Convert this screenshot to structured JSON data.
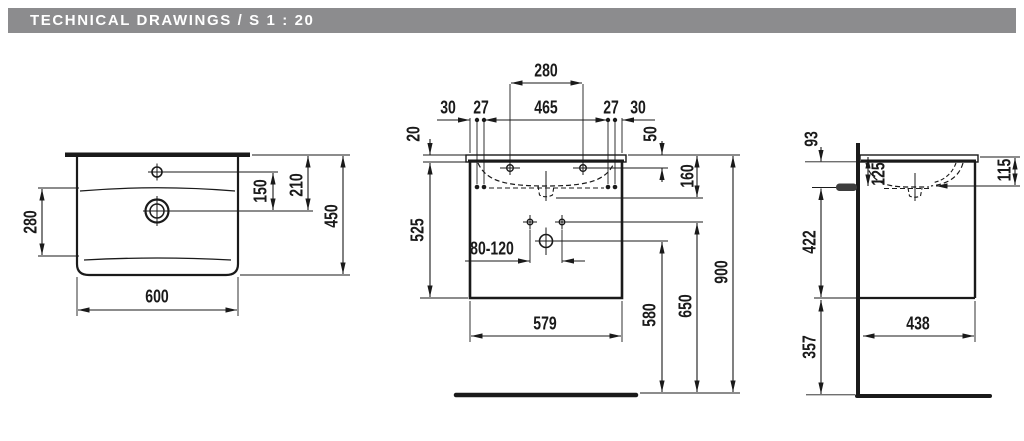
{
  "header": {
    "title": "TECHNICAL DRAWINGS / S 1 : 20"
  },
  "colors": {
    "header_bg": "#8c8c8e",
    "header_text": "#ffffff",
    "line": "#1a1a1a",
    "background": "#ffffff"
  },
  "dims": {
    "basin_width": "600",
    "basin_height": "450",
    "basin_inner_depth": "280",
    "faucet_to_drain": "150",
    "top_to_drain": "210",
    "tap_hole_span": "280",
    "edge_30": "30",
    "offset_27": "27",
    "inner_span": "465",
    "top_thickness": "20",
    "top_to_tap_hole": "50",
    "top_to_bowl_bottom": "160",
    "cabinet_height": "525",
    "trap_range": "80-120",
    "cabinet_width": "579",
    "drain_height": "580",
    "outlet_height": "650",
    "rim_height": "900",
    "wall_outlet_93": "93",
    "top_to_outlet_125": "125",
    "top_to_bowl_115": "115",
    "outlet_to_bottom_422": "422",
    "cabinet_depth_438": "438",
    "bottom_to_floor_357": "357"
  }
}
